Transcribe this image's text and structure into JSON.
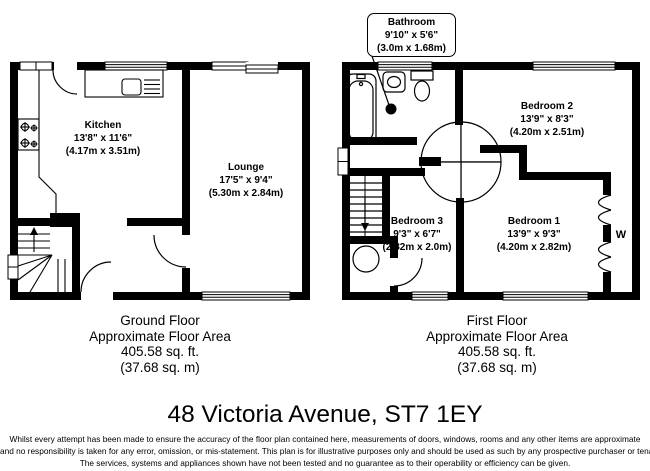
{
  "title": "48 Victoria Avenue, ST7 1EY",
  "disclaimer_lines": [
    "Whilst every attempt has been made to ensure the accuracy of the floor plan contained here, measurements of doors, windows, rooms and any other items are approximate",
    "and no responsibility is taken for any error, omission, or mis-statement. This plan is for illustrative purposes only and should be used as such by any prospective purchaser or tenant.",
    "The services, systems and appliances shown have not been tested and no guarantee as to their operability or efficiency can be given."
  ],
  "colors": {
    "wall": "#000000",
    "background": "#ffffff"
  },
  "ground_floor": {
    "rooms": {
      "kitchen": {
        "name": "Kitchen",
        "imperial": "13'8\" x 11'6\"",
        "metric": "(4.17m x 3.51m)"
      },
      "lounge": {
        "name": "Lounge",
        "imperial": "17'5\" x 9'4\"",
        "metric": "(5.30m x 2.84m)"
      }
    },
    "caption": {
      "floor_label": "Ground Floor",
      "area_label": "Approximate Floor Area",
      "area_imperial": "405.58 sq. ft.",
      "area_metric": "(37.68 sq. m)"
    }
  },
  "first_floor": {
    "rooms": {
      "bedroom2": {
        "name": "Bedroom 2",
        "imperial": "13'9\" x 8'3\"",
        "metric": "(4.20m x 2.51m)"
      },
      "bedroom3": {
        "name": "Bedroom 3",
        "imperial": "9'3\" x 6'7\"",
        "metric": "(2.82m x 2.0m)"
      },
      "bedroom1": {
        "name": "Bedroom 1",
        "imperial": "13'9\" x 9'3\"",
        "metric": "(4.20m x 2.82m)"
      }
    },
    "bathroom_callout": {
      "name": "Bathroom",
      "imperial": "9'10\" x 5'6\"",
      "metric": "(3.0m x 1.68m)"
    },
    "wardrobe_label": "W",
    "caption": {
      "floor_label": "First Floor",
      "area_label": "Approximate Floor Area",
      "area_imperial": "405.58 sq. ft.",
      "area_metric": "(37.68 sq. m)"
    }
  }
}
